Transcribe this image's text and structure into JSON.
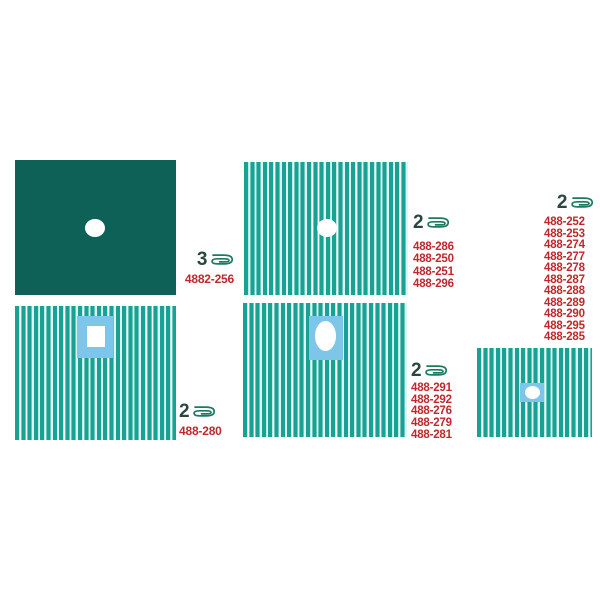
{
  "colors": {
    "solid_drape": "#0d6157",
    "stripe_teal": "#17a294",
    "stripe_light": "#bfe9e4",
    "patch_blue": "#7ec6e9",
    "code_red": "#c0272d",
    "icon_green": "#1b7a60",
    "qty_dark": "#2b463f",
    "background": "#ffffff"
  },
  "groups": [
    {
      "qty": "3",
      "codes": [
        "4882-256"
      ]
    },
    {
      "qty": "2",
      "codes": [
        "488-286",
        "488-250",
        "488-251",
        "488-296"
      ]
    },
    {
      "qty": "2",
      "codes": [
        "488-252",
        "488-253",
        "488-274",
        "488-277",
        "488-278",
        "488-287",
        "488-288",
        "488-289",
        "488-290",
        "488-295",
        "488-285"
      ]
    },
    {
      "qty": "2",
      "codes": [
        "488-280"
      ]
    },
    {
      "qty": "2",
      "codes": [
        "488-291",
        "488-292",
        "488-276",
        "488-279",
        "488-281"
      ]
    }
  ],
  "icons": {
    "fold_icon": "folded-drape-icon"
  }
}
